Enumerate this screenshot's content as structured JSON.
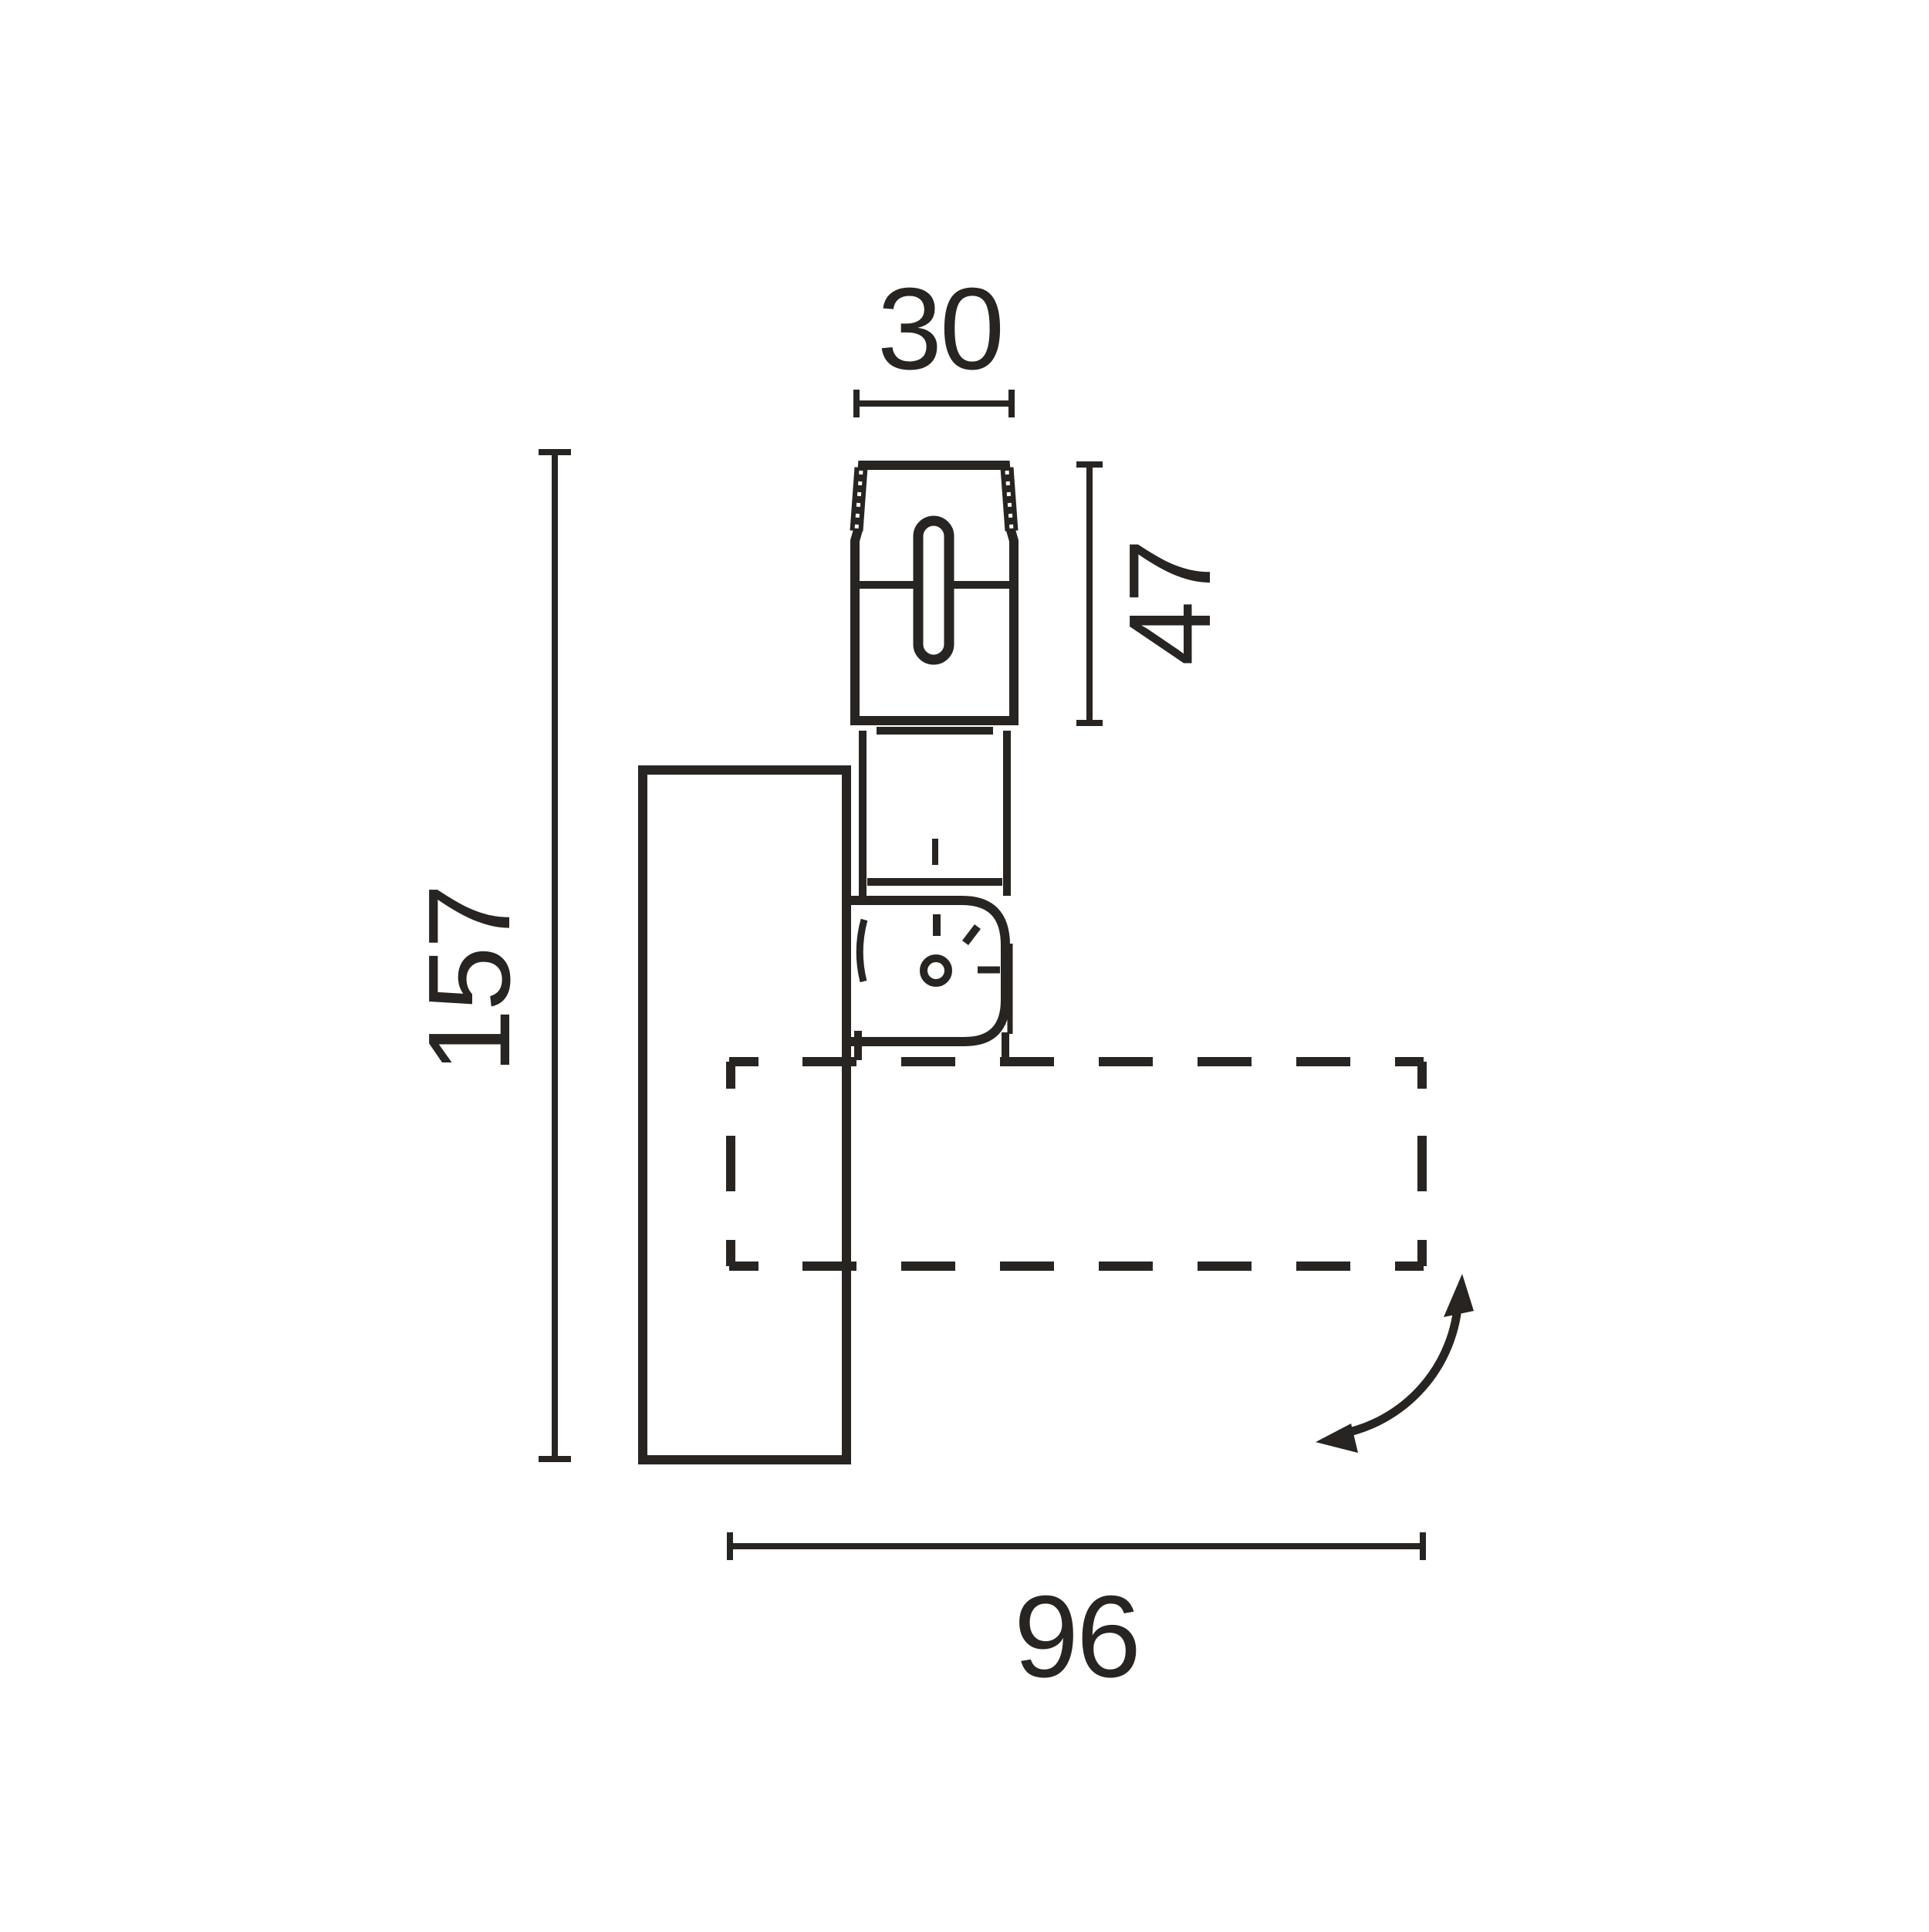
{
  "drawing": {
    "colors": {
      "ink": "#272421",
      "paper": "#ffffff"
    },
    "dimensions": {
      "top_width": {
        "value": "30"
      },
      "adapter_height": {
        "value": "47"
      },
      "overall_height": {
        "value": "157"
      },
      "projection": {
        "value": "96"
      }
    }
  }
}
